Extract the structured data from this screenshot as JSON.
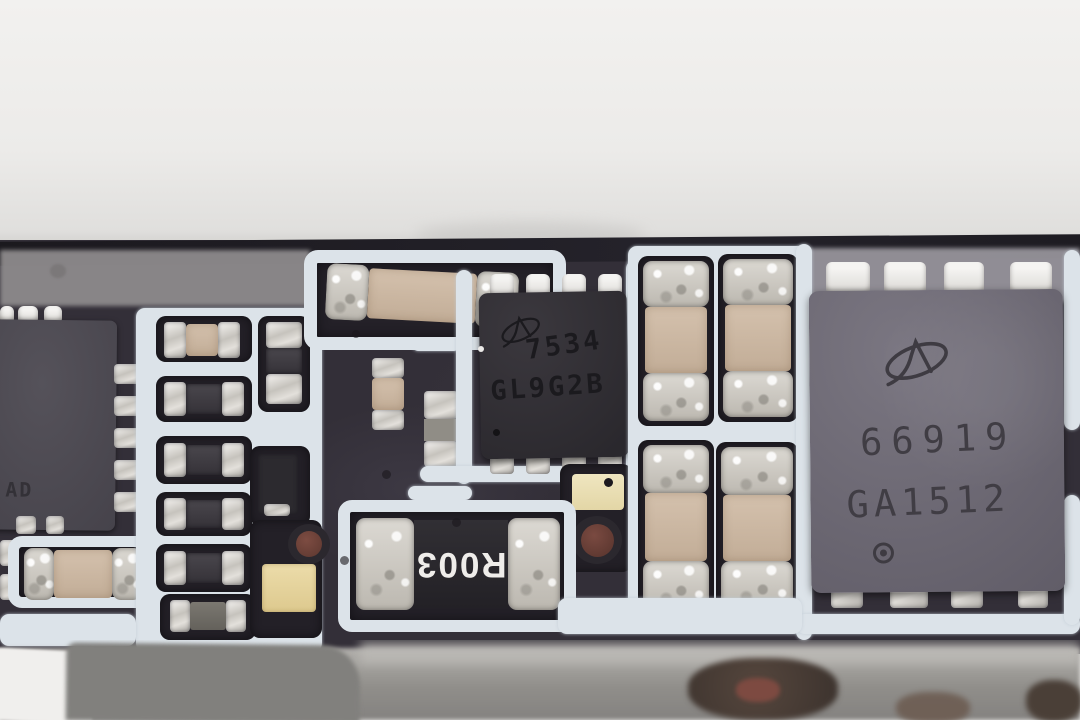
{
  "photo_subject": "circuit-board-macro",
  "board": {
    "chips": {
      "left_ic": {
        "marking_partial": "AD"
      },
      "small_mosfet": {
        "logo": "AO",
        "marking_line1": "7534",
        "marking_line2": "GL9G2B"
      },
      "large_mosfet": {
        "logo": "AO",
        "marking_line1": "66919",
        "marking_line2": "GA1512"
      },
      "shunt_resistor": {
        "marking": "R003"
      }
    },
    "colors": {
      "background_top": "#efeeec",
      "pcb_substrate": "#332f38",
      "pcb_pocket": "#232027",
      "white_glue": "#dce3e9",
      "ceramic_tan": "#c9b5a1",
      "solder_silver": "#cfccc6",
      "chip_black": "#2e2c31",
      "chip_gray": "#6b6770",
      "gold_pad": "#e6d6a0",
      "cream_pad": "#eee4ba",
      "via_maroon": "#6b4038",
      "foreground_gray": "#908e8a"
    }
  }
}
